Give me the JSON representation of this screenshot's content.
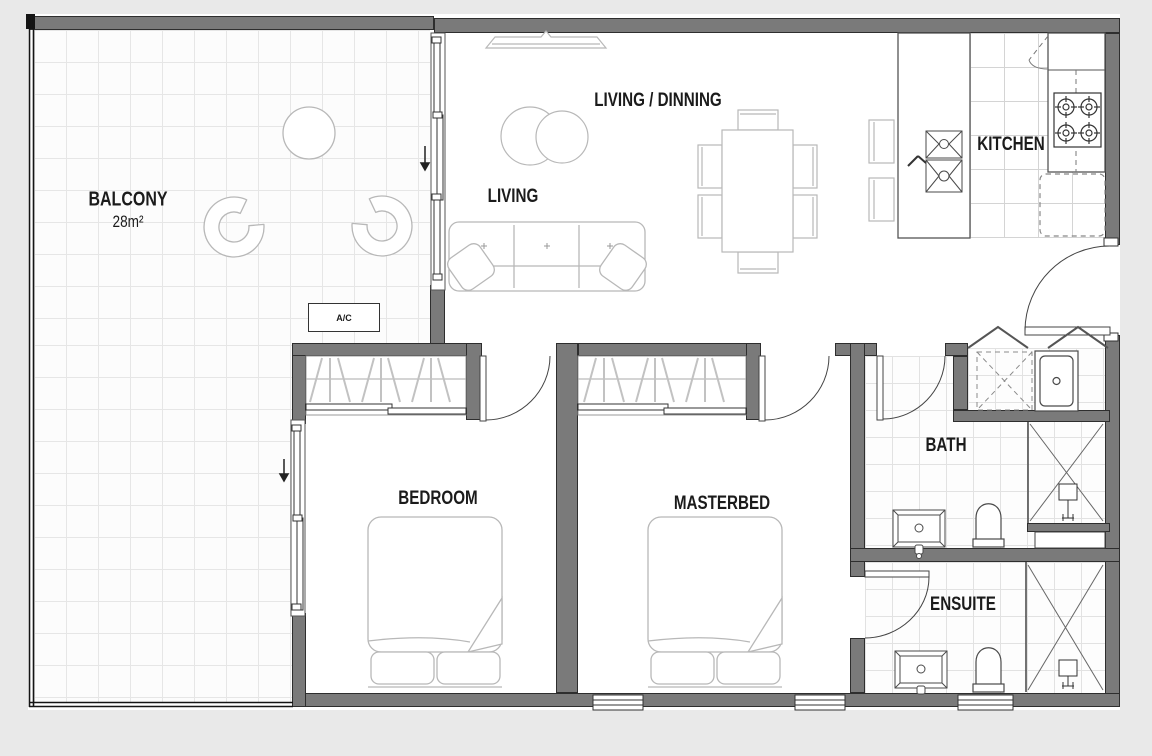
{
  "rooms": {
    "balcony": {
      "label": "BALCONY",
      "area": "28m²"
    },
    "living_dining": {
      "label": "LIVING / DINNING"
    },
    "living": {
      "label": "LIVING"
    },
    "kitchen": {
      "label": "KITCHEN"
    },
    "bedroom": {
      "label": "BEDROOM"
    },
    "masterbed": {
      "label": "MASTERBED"
    },
    "bath": {
      "label": "BATH"
    },
    "ensuite": {
      "label": "ENSUITE"
    }
  },
  "equipment": {
    "ac": "A/C"
  },
  "colors": {
    "background": "#e9e9e9",
    "floor": "#ffffff",
    "wall": "#7a7a7a",
    "wall_edge": "#2e2e2e",
    "furniture": "#b8b8b8",
    "fixture": "#4a4a4a",
    "text": "#1b1b1b"
  }
}
